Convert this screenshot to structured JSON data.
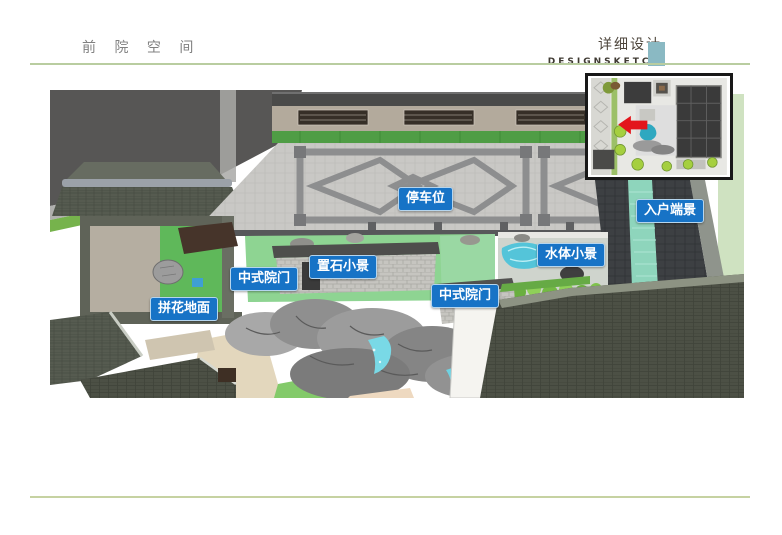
{
  "header": {
    "title": "前 院 空 间",
    "subtitle_cn": "详细设计",
    "subtitle_en": "DESIGNSKETCH"
  },
  "colors": {
    "accent": "#8ab9c3",
    "hline": "#b9cda0",
    "fline": "#c6d2a2",
    "label": "#1773c6"
  },
  "inset": {
    "icon": "red-location-arrow",
    "arrow_color": "#e3151c"
  },
  "annotations": [
    {
      "text": "停车位",
      "x": 398,
      "y": 187
    },
    {
      "text": "入户端景",
      "x": 636,
      "y": 199
    },
    {
      "text": "水体小景",
      "x": 537,
      "y": 243
    },
    {
      "text": "置石小景",
      "x": 309,
      "y": 255
    },
    {
      "text": "中式院门",
      "x": 230,
      "y": 267
    },
    {
      "text": "中式院门",
      "x": 431,
      "y": 284
    },
    {
      "text": "拼花地面",
      "x": 150,
      "y": 297
    }
  ]
}
